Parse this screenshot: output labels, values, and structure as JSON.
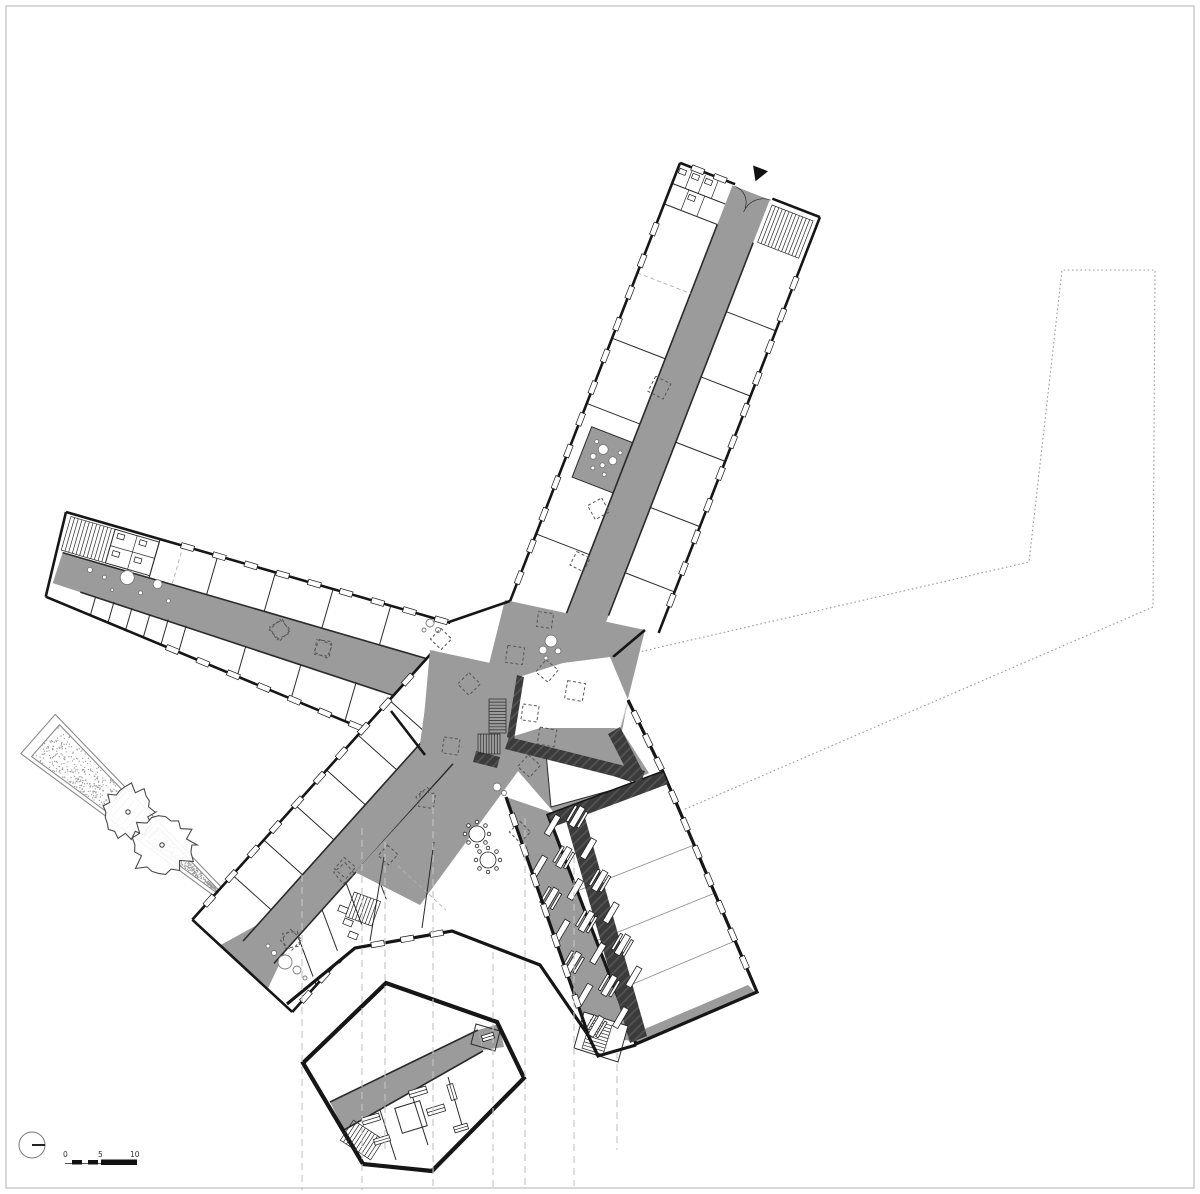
{
  "scale_bar": {
    "labels": [
      "0",
      "5",
      "10"
    ]
  },
  "north_indicator": {
    "symbol": "circle-with-line"
  },
  "entrance_marker": {
    "symbol": "filled-triangle"
  },
  "palette": {
    "background": "#ffffff",
    "frame": "#bdbdbd",
    "floor_gray": "#9b9b9b",
    "floor_light": "#c6c6c6",
    "dark_wall": "#3b3b3b",
    "dark_wall_hatch": "#565656",
    "wall_black": "#161616",
    "line_thin": "#2a2a2a",
    "divider_gray": "#8a8a8a",
    "dashed_gray": "#c4c4c4",
    "dotted_site": "#9a9a9a",
    "stipple": "#9a9a9a",
    "tree_stroke": "#4a4a4a",
    "text": "#333333"
  }
}
